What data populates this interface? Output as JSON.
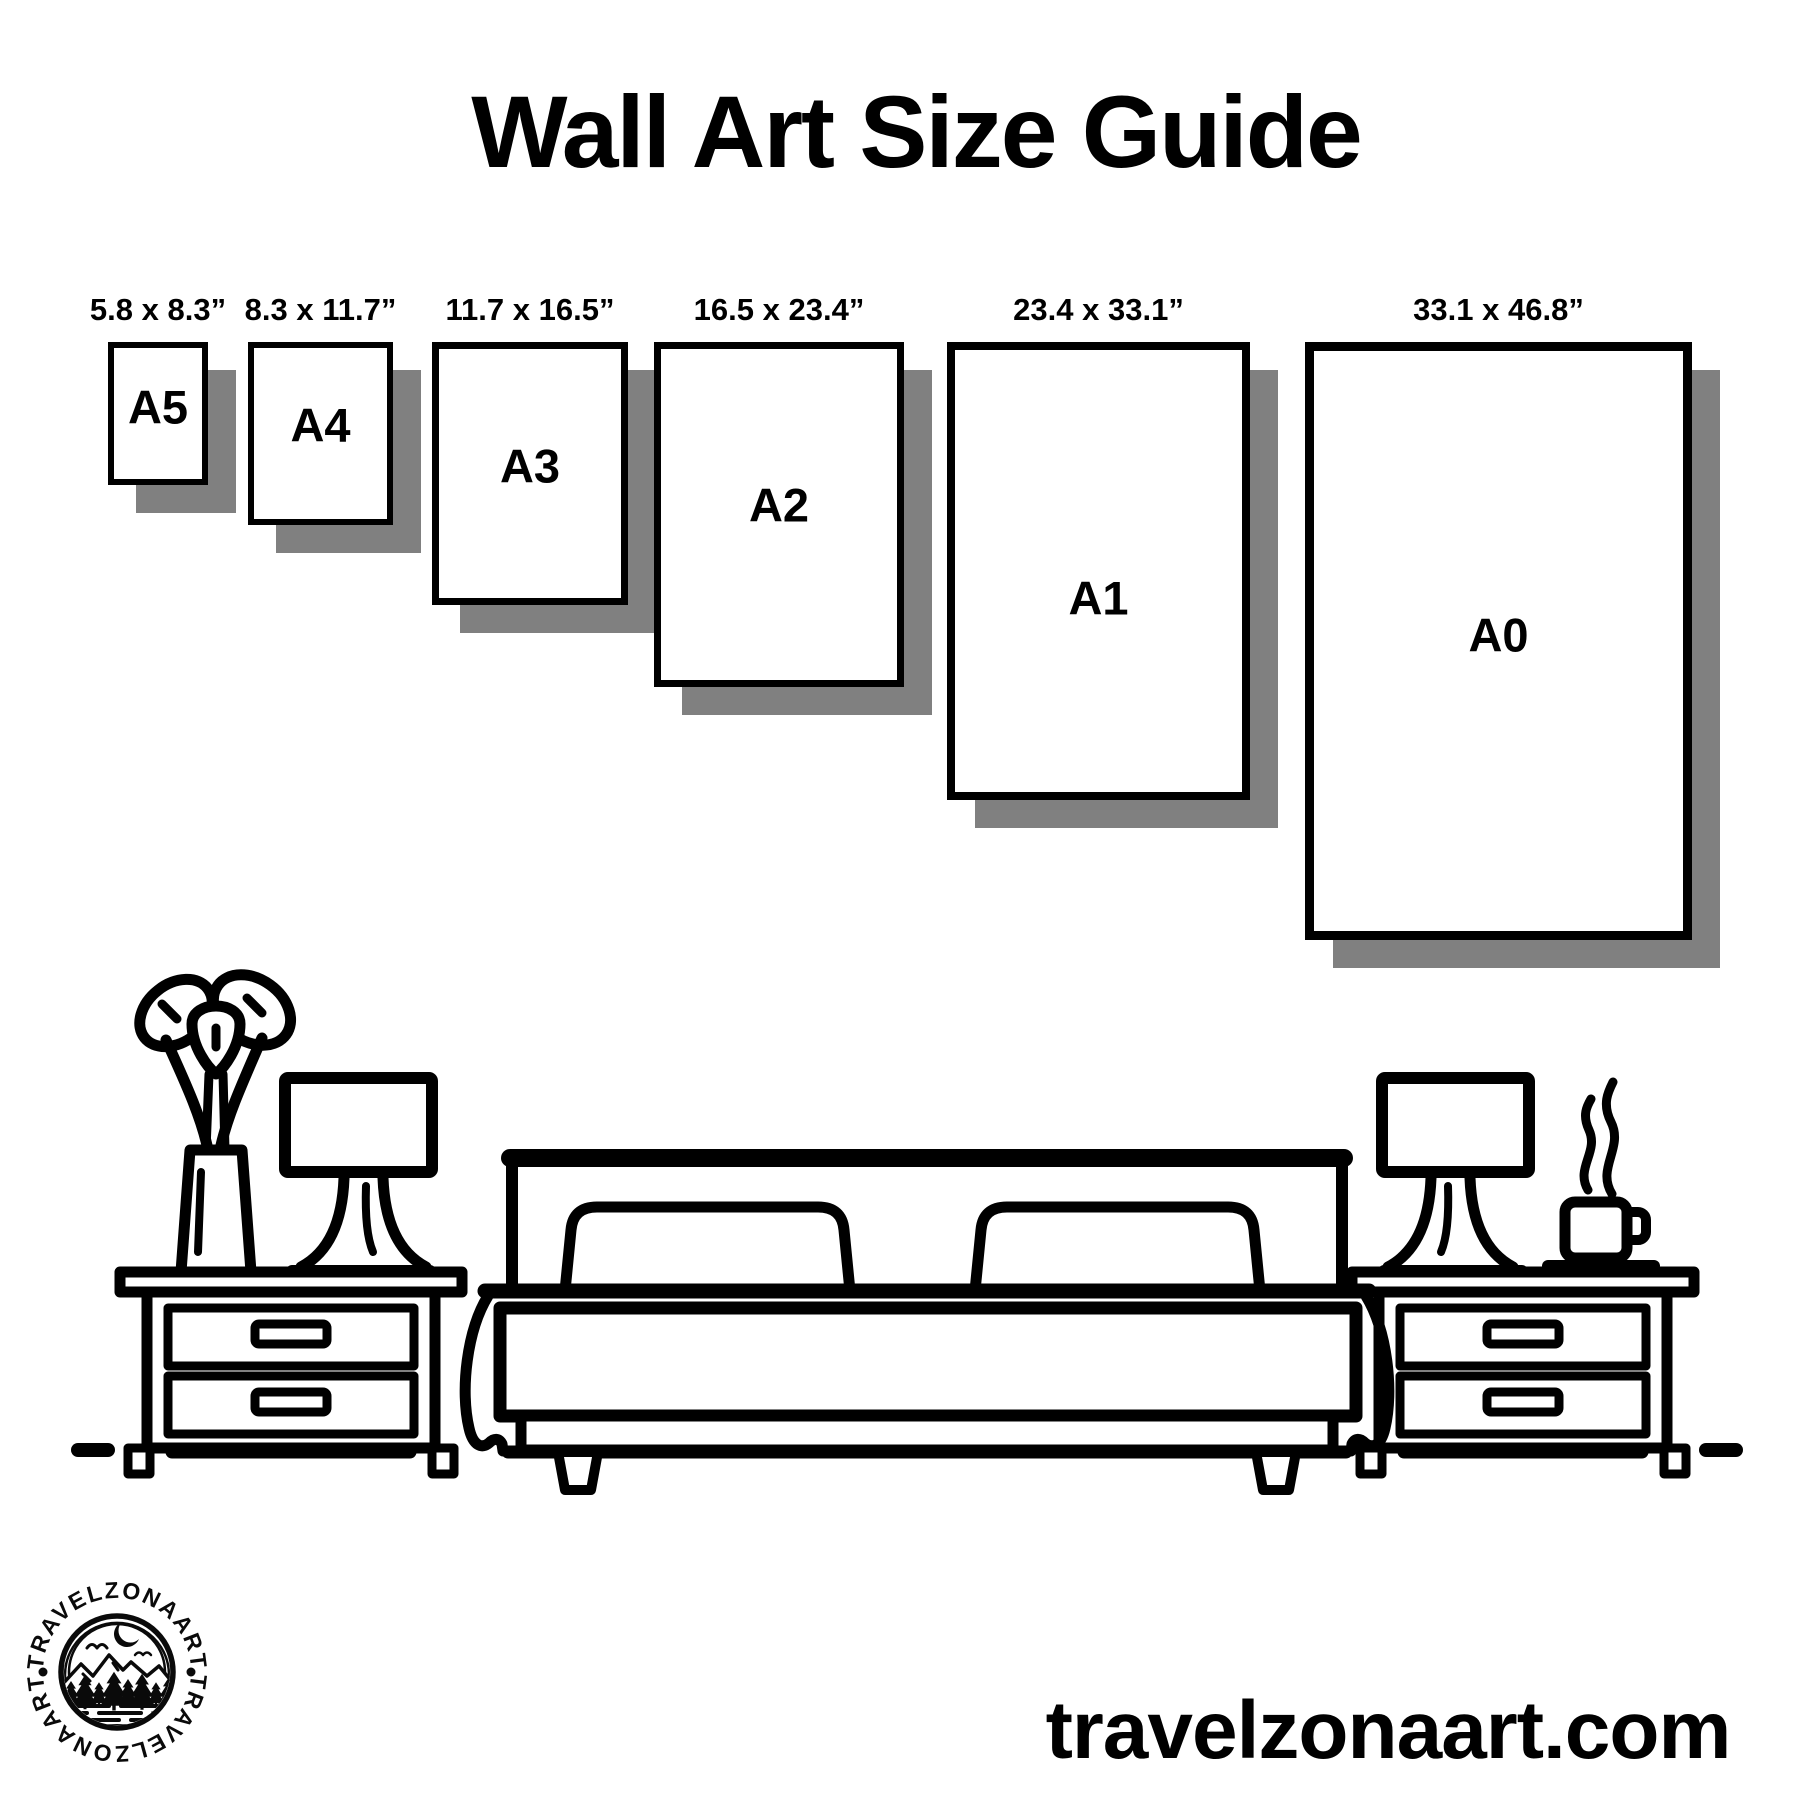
{
  "title": "Wall Art Size Guide",
  "papers": [
    {
      "name": "A5",
      "dimensions": "5.8 x 8.3”"
    },
    {
      "name": "A4",
      "dimensions": "8.3 x 11.7”"
    },
    {
      "name": "A3",
      "dimensions": "11.7 x 16.5”"
    },
    {
      "name": "A2",
      "dimensions": "16.5 x 23.4”"
    },
    {
      "name": "A1",
      "dimensions": "23.4 x 33.1”"
    },
    {
      "name": "A0",
      "dimensions": "33.1 x 46.8”"
    }
  ],
  "website": "travelzonaart.com",
  "logo": {
    "ring_text": "TRAVELZONAART"
  },
  "colors": {
    "ink": "#000000",
    "shadow": "#808080",
    "background": "#ffffff"
  }
}
